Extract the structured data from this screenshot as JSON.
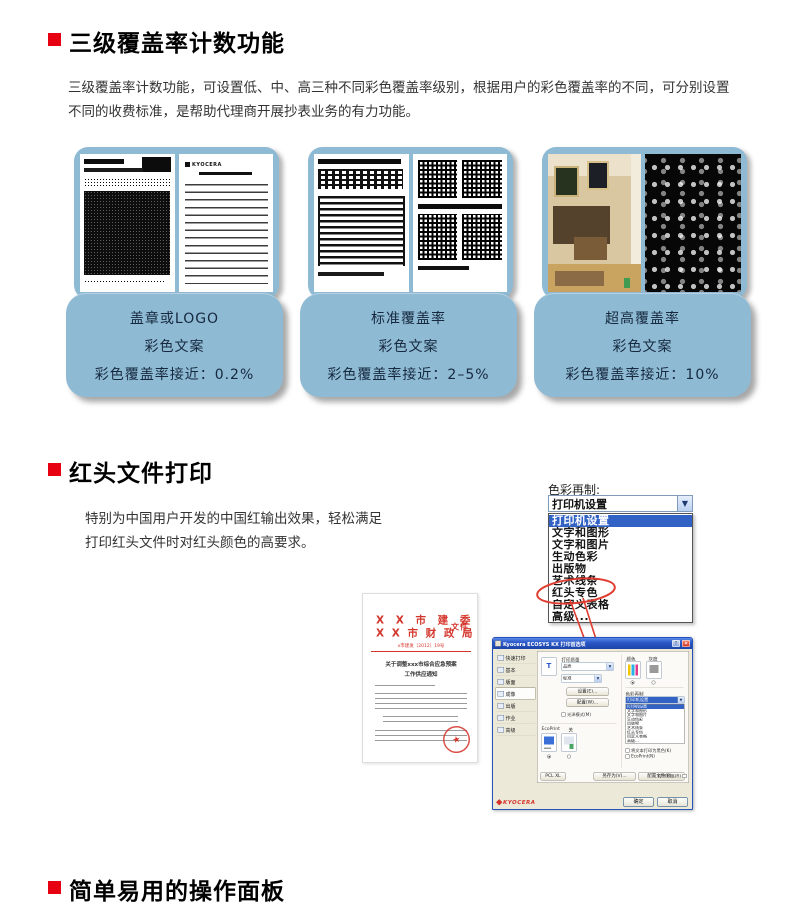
{
  "page": {
    "accent_red": "#e60012",
    "card_blue": "#8fbad4",
    "card_text_color": "#16293f"
  },
  "section1": {
    "title": "三级覆盖率计数功能",
    "body": "三级覆盖率计数功能，可设置低、中、高三种不同彩色覆盖率级别，根据用户的彩色覆盖率的不同，可分别设置不同的收费标准，是帮助代理商开展抄表业务的有力功能。",
    "doc_logo": "KYOCERA",
    "cards": [
      {
        "line1": "盖章或LOGO",
        "line2": "彩色文案",
        "line3": "彩色覆盖率接近：0.2%"
      },
      {
        "line1": "标准覆盖率",
        "line2": "彩色文案",
        "line3": "彩色覆盖率接近：2–5%"
      },
      {
        "line1": "超高覆盖率",
        "line2": "彩色文案",
        "line3": "彩色覆盖率接近：10%"
      }
    ]
  },
  "section2": {
    "title": "红头文件打印",
    "body_line1": "特别为中国用户开发的中国红输出效果，轻松满足",
    "body_line2": "打印红头文件时对红头颜色的高要求。",
    "dropdown": {
      "label": "色彩再制:",
      "selected": "打印机设置",
      "arrow": "▼",
      "items": [
        "打印机设置",
        "文字和图形",
        "文字和图片",
        "生动色彩",
        "出版物",
        "艺术线条",
        "红头专色",
        "自定义表格",
        "高级..."
      ],
      "circled_item": "红头专色"
    },
    "red_doc": {
      "header_line1": "X X 市 建 委",
      "header_line2": "X X 市 财 政 局",
      "header_suffix": "文件",
      "doc_number": "x市建发〔2012〕19号",
      "title_line1": "关于调整xxx市综合应急预案",
      "title_line2": "工作供应通知",
      "seal_star": "★"
    },
    "dialog": {
      "title": "Kyocera ECOSYS KX 打印首选项",
      "help_btn": "?",
      "close_btn": "×",
      "tabs": [
        "快速打印",
        "基本",
        "版面",
        "成像",
        "出版",
        "作业",
        "高级"
      ],
      "selected_tab": "成像",
      "center": {
        "page_icon_letter": "T",
        "quality_label": "打印质量",
        "combo1": "品质",
        "combo2": "标准",
        "btn1": "设置(E)...",
        "btn2": "配置(W)...",
        "check1": "光泽模式(M)",
        "ecoprint_label": "EcoPrint",
        "ecoprint_off": "关"
      },
      "right": {
        "color_label": "颜色",
        "gray_label": "灰度",
        "repro_label": "色彩再制",
        "combo_selected": "打印机设置",
        "list_items": [
          "打印机设置",
          "文字和图形",
          "文字和图片",
          "生动色彩",
          "出版物",
          "艺术线条",
          "红头专色",
          "自定义表格",
          "高级..."
        ],
        "check1": "将文本打印为黑色(K)",
        "check2": "EcoPrint(N)"
      },
      "bottom": {
        "pcl": "PCL XL",
        "save_as": "另存为(V)...",
        "profiles": "配置文件(F)...",
        "preview": "打印预览(R)",
        "brand": "KYOCERA",
        "ok": "确定",
        "cancel": "取消"
      }
    }
  },
  "section3": {
    "title": "简单易用的操作面板"
  }
}
